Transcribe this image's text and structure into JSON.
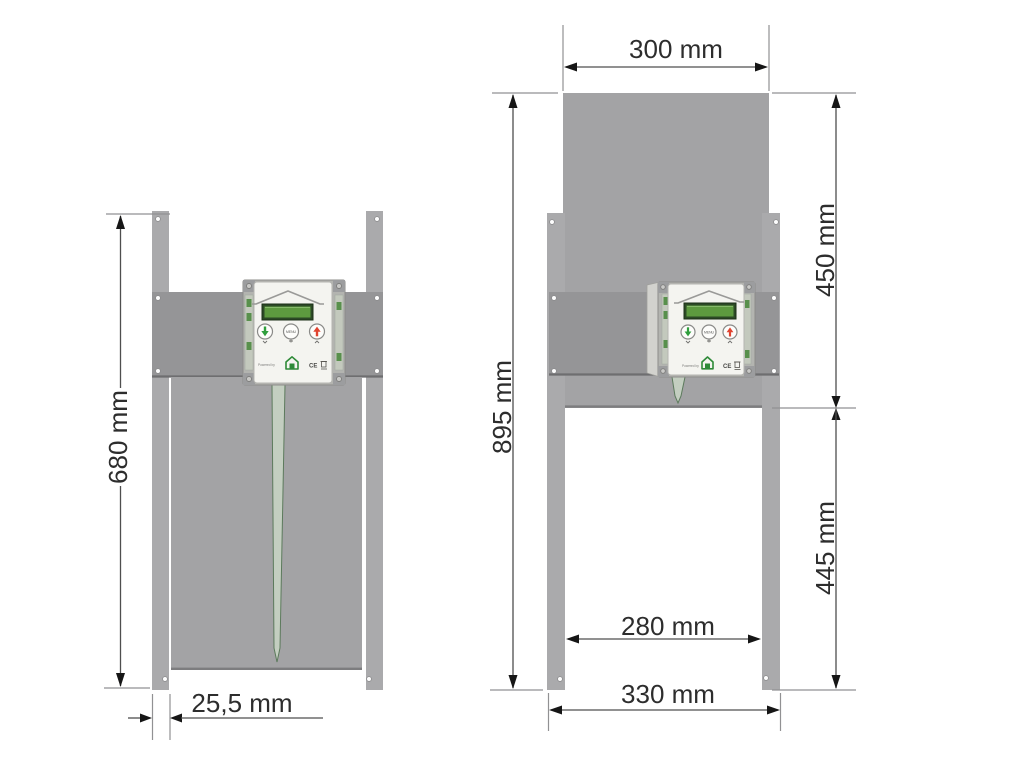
{
  "left_view": {
    "height_label": "680 mm",
    "rail_depth_label": "25,5 mm"
  },
  "right_view": {
    "door_width_label": "300 mm",
    "upper_height_label": "450 mm",
    "total_height_label": "895 mm",
    "lower_height_label": "445 mm",
    "opening_width_label": "280 mm",
    "outer_width_label": "330 mm"
  },
  "control_unit": {
    "menu_button_label": "MENU",
    "powered_by_label": "Powered by",
    "ce_mark": "CE"
  },
  "colors": {
    "door_gray": "#a3a3a5",
    "plate_gray": "#959597",
    "rail_gray": "#aaaaac",
    "unit_body": "#b3b4b0",
    "unit_side": "#d2d2ce",
    "unit_panel": "#f4f4f0",
    "lcd_frame": "#2c4a26",
    "lcd_screen": "#5d9a3f",
    "button_green": "#2f9e3c",
    "button_red": "#e04430",
    "tape_fill": "#c3cec0",
    "tape_stroke": "#5c7a5c",
    "logo_green": "#2e8a38"
  }
}
